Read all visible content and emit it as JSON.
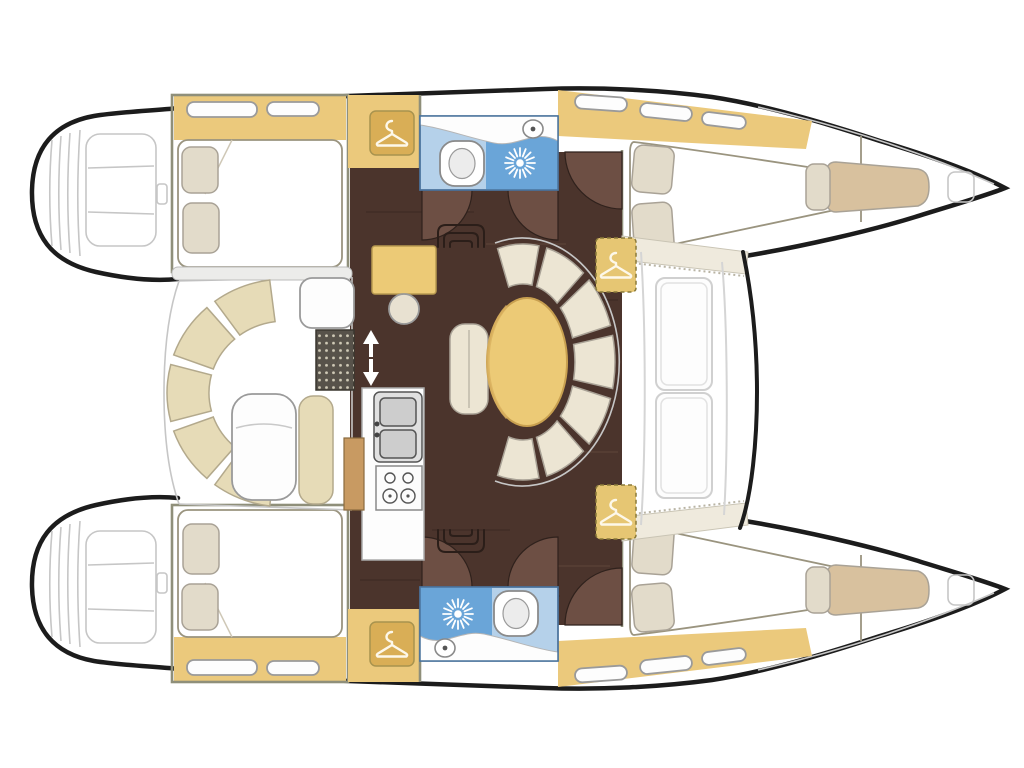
{
  "title": "Catamaran interior floor plan, top-down view (bow right, stern left)",
  "plan": {
    "vessel_type": "sailing catamaran",
    "view": "overhead interior layout diagram",
    "orientation": {
      "bow": "right",
      "stern": "left"
    },
    "areas": {
      "port_hull": [
        "aft double-bed cabin with pillows and shelf lockers",
        "wardrobe with hanger symbol",
        "head with washbasin counter, toilet and shower",
        "companionway steps",
        "forward double-bed cabin",
        "dashed wardrobe locker",
        "bow berth with pillow",
        "anchor locker hatch",
        "stern swim steps"
      ],
      "starboard_hull": [
        "aft double-bed cabin with pillows and shelf lockers",
        "wardrobe with hanger symbol",
        "head with shower, washbasin counter and toilet",
        "companionway steps",
        "forward double-bed cabin",
        "dashed wardrobe locker",
        "bow berth with pillow",
        "anchor locker hatch",
        "stern swim steps"
      ],
      "bridgedeck": [
        "aft cockpit with curved bench, white table, bench seat and teak grate",
        "sliding door with up-down arrows",
        "salon with dark wood floor",
        "chart desk with round stool",
        "galley with double sink and two-burner stove",
        "oval dining table with curved settee and chaise bench",
        "foredeck windshield with two windows"
      ]
    },
    "furniture_counts": {
      "double_beds": 4,
      "bow_berths": 2,
      "toilets": 2,
      "showers": 2,
      "wardrobe_icons": 4,
      "tables": 2,
      "door_swing_arcs": 6
    }
  },
  "colors": {
    "outline": "#1c1c1c",
    "deck_line": "#c6c6c6",
    "white": "#fdfdfd",
    "shelf_yellow": "#ebc97c",
    "box_gold": "#d9ae56",
    "box_gold_light": "#e6c673",
    "wood_floor": "#4b342c",
    "wood_light": "#6d4f44",
    "wood_door": "#c89a62",
    "bed_cream": "#ece4d2",
    "pillow": "#e2dbca",
    "bench_beige": "#e6dbb7",
    "settee_cream": "#ece5d3",
    "bath_light": "#b5d1ea",
    "bath_deep": "#6aa5d8",
    "berth_tan": "#d8c19e",
    "table_yellow": "#ecca76",
    "stool": "#e8e1d1",
    "grate": "#57524a",
    "grate_dot": "#cfc9b6",
    "steel": "#ececea",
    "windshield": "#efeadd"
  }
}
